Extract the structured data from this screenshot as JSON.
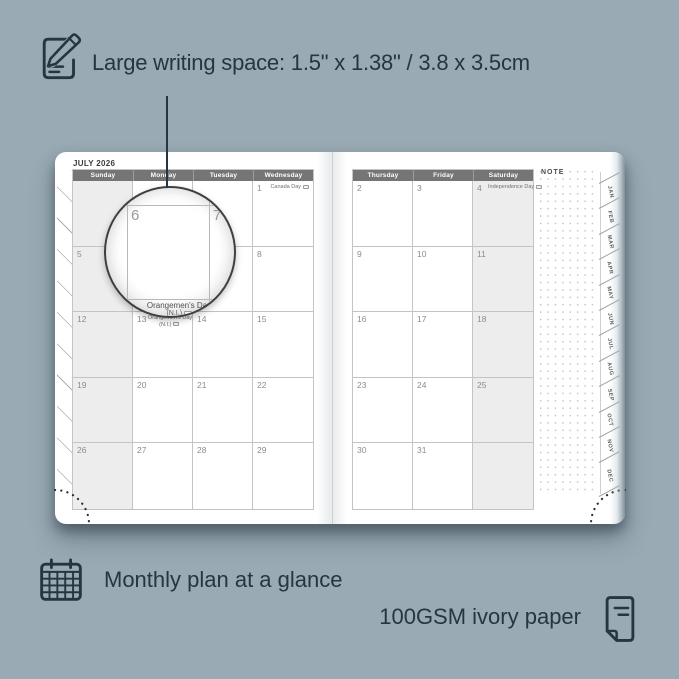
{
  "annotations": {
    "top": "Large writing space: 1.5\" x 1.38\" / 3.8 x 3.5cm",
    "bottom_left": "Monthly plan at a glance",
    "bottom_right": "100GSM ivory paper"
  },
  "colors": {
    "background": "#99aab4",
    "ink": "#263640",
    "page": "#ffffff",
    "header_band": "#757575",
    "weekend_shade": "#ededed",
    "grid_line": "#c4c4c4",
    "day_number": "#8c8c8c"
  },
  "icons": {
    "top": "pencil-note-icon",
    "bottom_left": "calendar-grid-icon",
    "bottom_right": "paper-sheet-icon",
    "holiday_badge": "holiday-flag-icon"
  },
  "planner": {
    "month_label": "JULY 2026",
    "note_label": "NOTE",
    "left_page": {
      "headers": [
        "Sunday",
        "Monday",
        "Tuesday",
        "Wednesday"
      ],
      "weekend_col": 0,
      "rows": [
        [
          {},
          {},
          {},
          {
            "d": "1",
            "h": [
              "Canada Day"
            ]
          }
        ],
        [
          {
            "d": "5"
          },
          {
            "d": "6"
          },
          {
            "d": "7"
          },
          {
            "d": "8"
          }
        ],
        [
          {
            "d": "12"
          },
          {
            "d": "13",
            "h": [
              "Orangemen's Day",
              "(N.I.)"
            ]
          },
          {
            "d": "14"
          },
          {
            "d": "15"
          }
        ],
        [
          {
            "d": "19"
          },
          {
            "d": "20"
          },
          {
            "d": "21"
          },
          {
            "d": "22"
          }
        ],
        [
          {
            "d": "26"
          },
          {
            "d": "27"
          },
          {
            "d": "28"
          },
          {
            "d": "29"
          }
        ]
      ]
    },
    "right_page": {
      "headers": [
        "Thursday",
        "Friday",
        "Saturday"
      ],
      "weekend_col": 2,
      "rows": [
        [
          {
            "d": "2"
          },
          {
            "d": "3"
          },
          {
            "d": "4",
            "h": [
              "Independence Day"
            ]
          }
        ],
        [
          {
            "d": "9"
          },
          {
            "d": "10"
          },
          {
            "d": "11"
          }
        ],
        [
          {
            "d": "16"
          },
          {
            "d": "17"
          },
          {
            "d": "18"
          }
        ],
        [
          {
            "d": "23"
          },
          {
            "d": "24"
          },
          {
            "d": "25"
          }
        ],
        [
          {
            "d": "30"
          },
          {
            "d": "31"
          },
          {}
        ]
      ]
    },
    "tabs": [
      "JAN",
      "FEB",
      "MAR",
      "APR",
      "MAY",
      "JUN",
      "JUL",
      "AUG",
      "SEP",
      "OCT",
      "NOV",
      "DEC"
    ],
    "magnifier": {
      "left_day": "6",
      "right_day": "7",
      "bottom_day": "13",
      "holiday": [
        "Orangemen's Day",
        "(N.I.)"
      ]
    }
  }
}
